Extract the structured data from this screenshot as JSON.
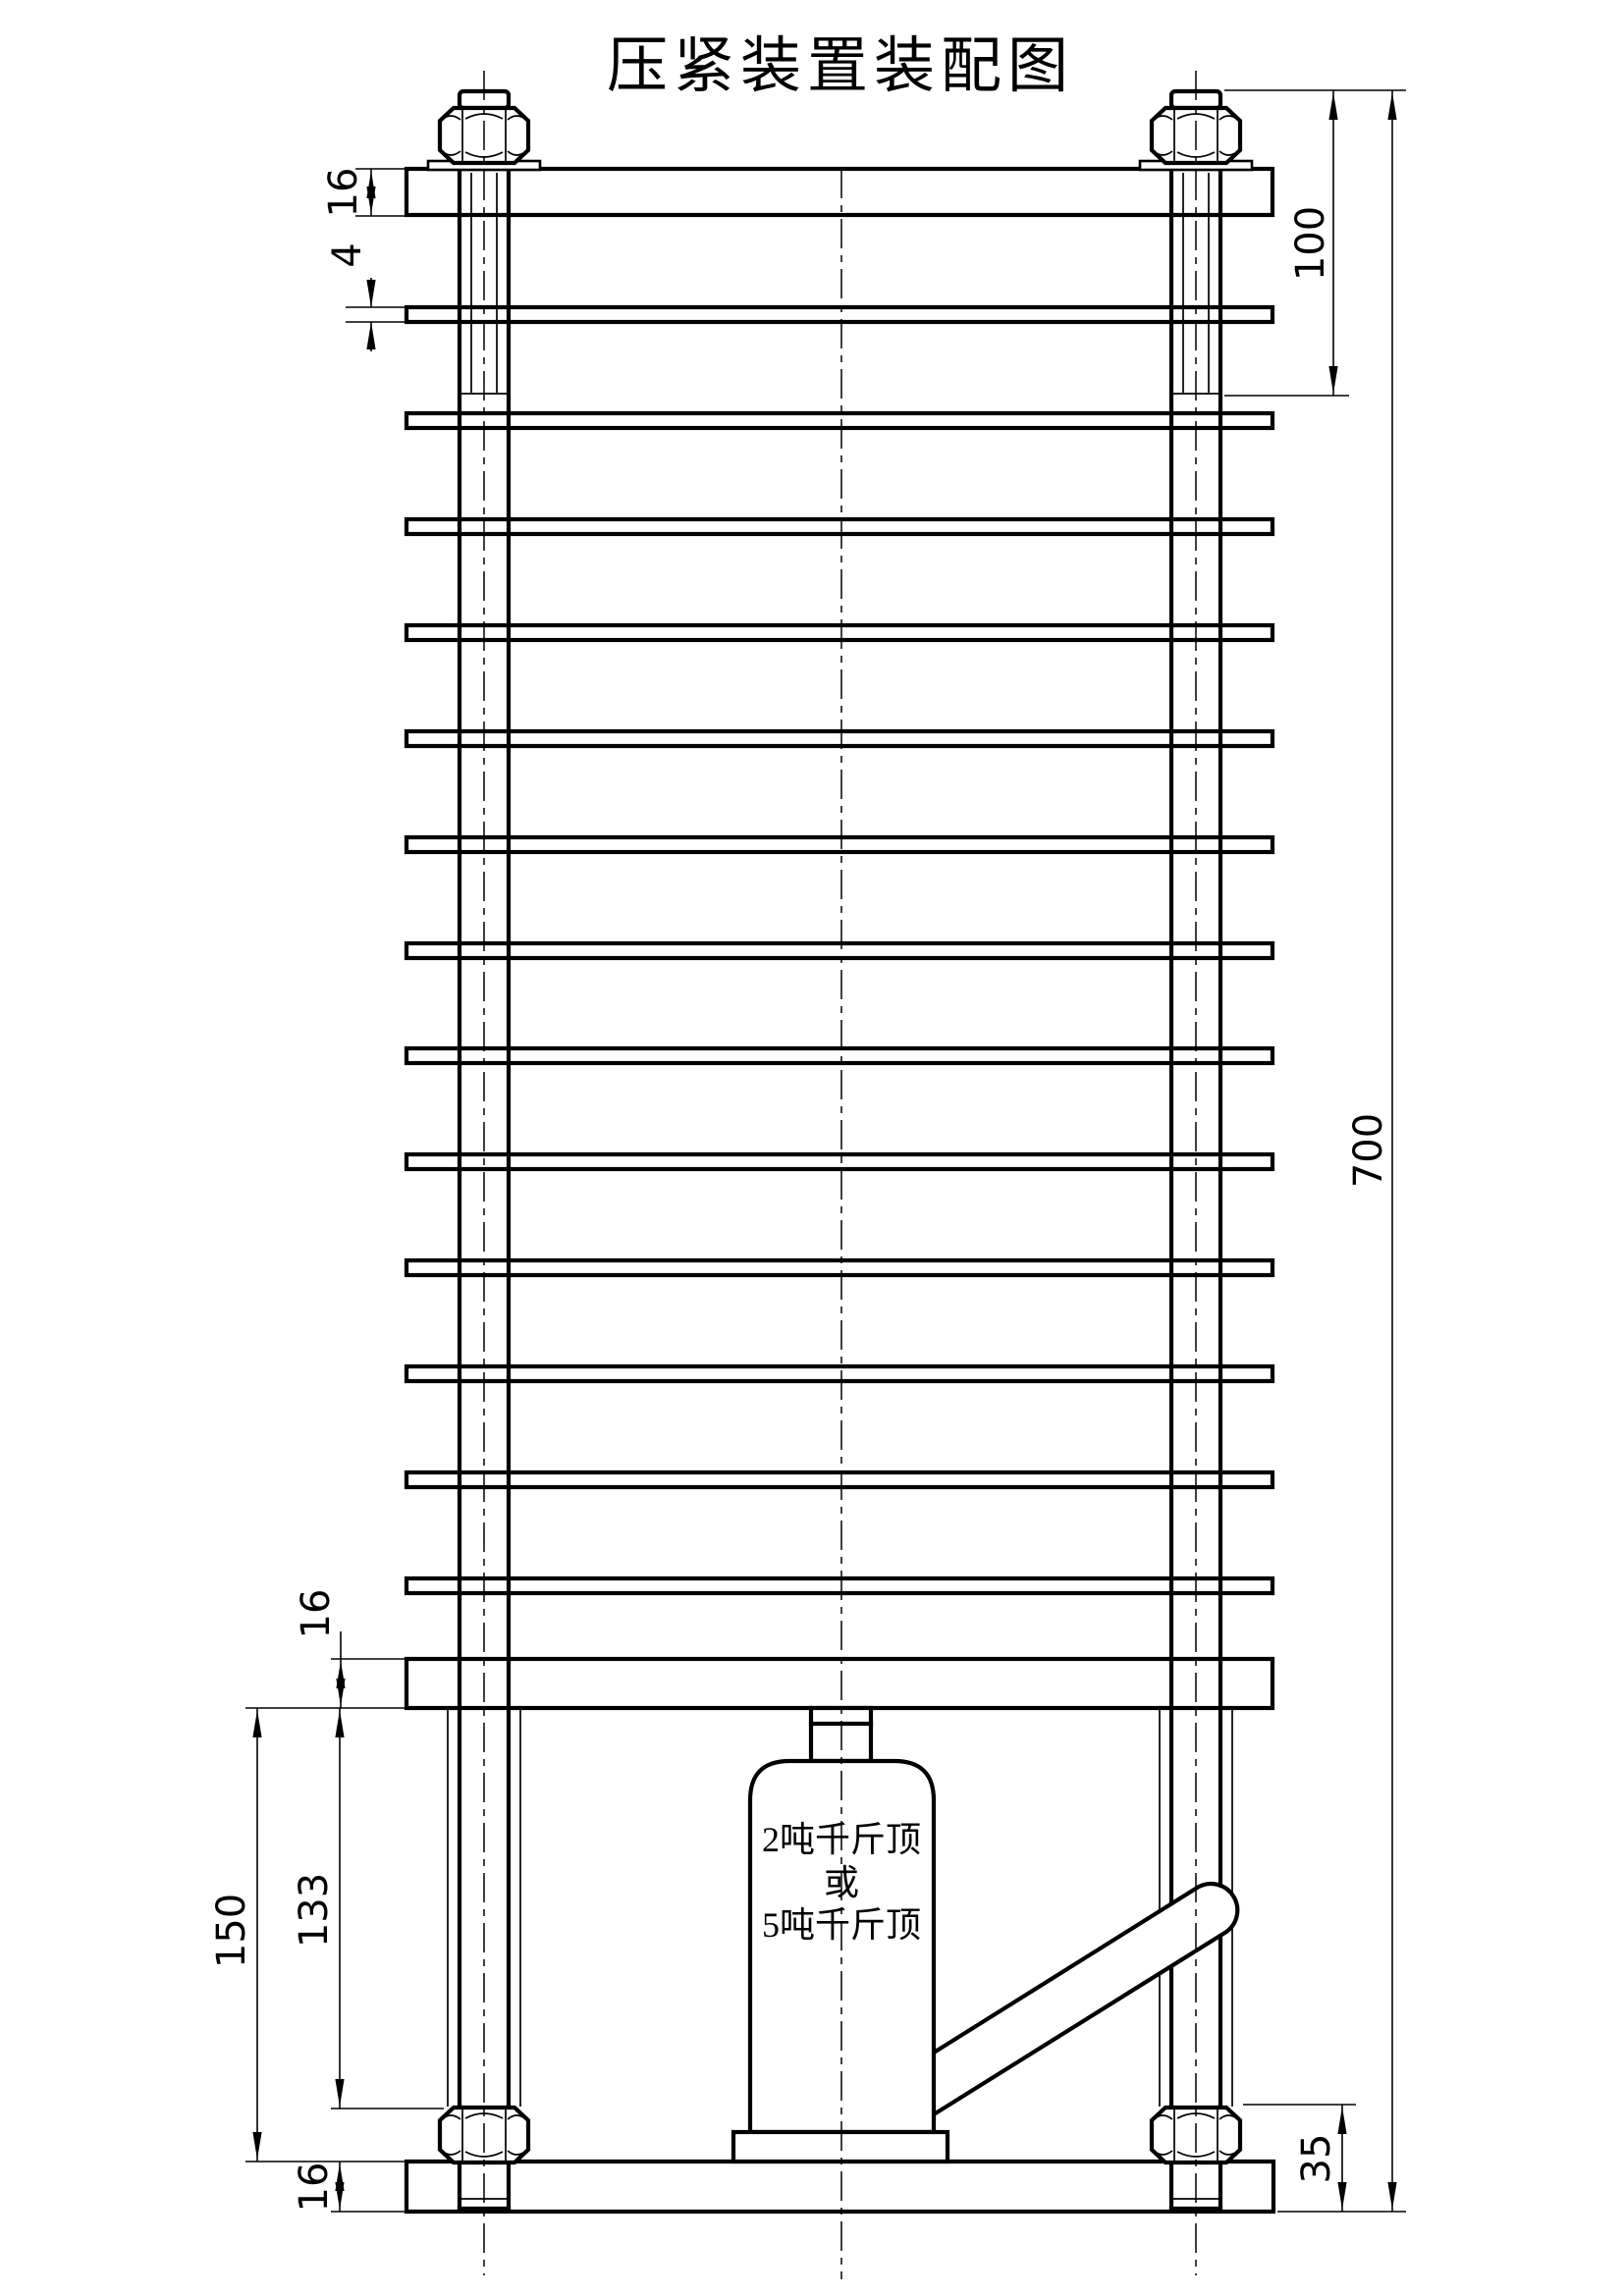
{
  "title": "压紧装置装配图",
  "jack": {
    "label_line1": "2吨千斤顶",
    "label_line2": "或",
    "label_line3": "5吨千斤顶"
  },
  "dimensions": {
    "top_plate_thickness": "16",
    "laminate_thickness": "4",
    "top_thread_length": "100",
    "overall_height": "700",
    "bottom_plate_thickness": "16",
    "jack_space_height": "150",
    "stud_exposed_length": "133",
    "nut_to_base_bottom": "35",
    "base_plate_thickness": "16"
  },
  "colors": {
    "line": "#000000",
    "background": "#ffffff"
  }
}
